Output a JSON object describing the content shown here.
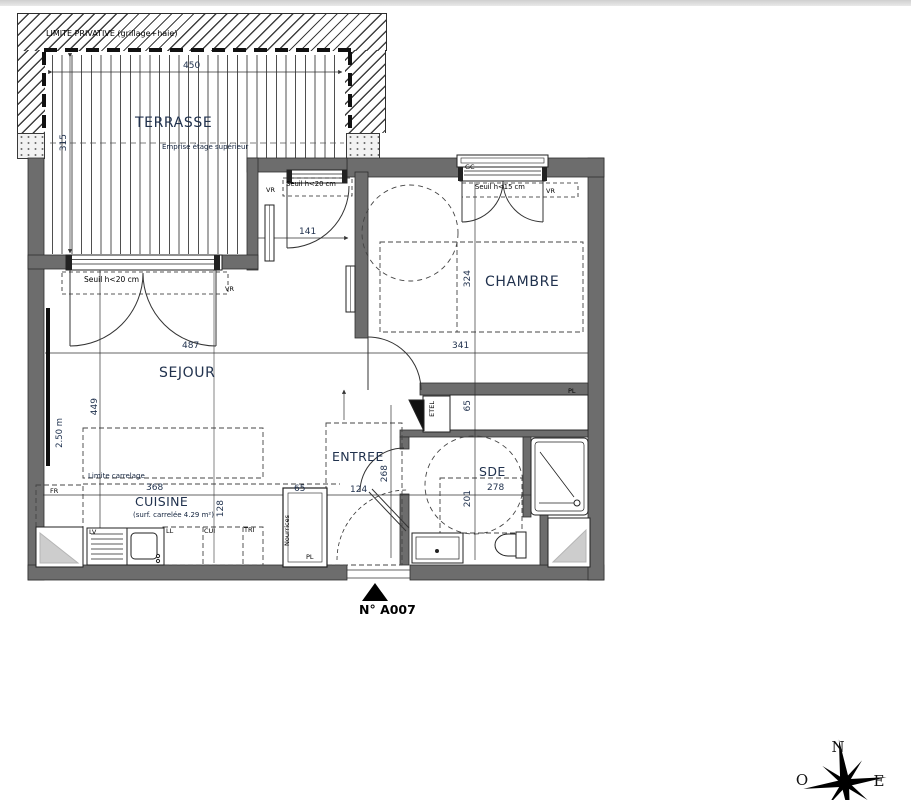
{
  "plan": {
    "boundary_label": "LIMITE PRIVATIVE (grillage+haie)",
    "unit_number": "N° A007",
    "terrace": {
      "name": "TERRASSE",
      "width": "450",
      "depth": "315",
      "upper_floor_note": "Emprise étage supérieur"
    },
    "living_room": {
      "name": "SEJOUR",
      "width": "487",
      "depth": "449",
      "ceiling_height": "2.50 m",
      "bay_threshold": "Seuil h<20 cm",
      "bay_shutter": "VR",
      "door_width": "141",
      "door_threshold": "Seuil h<20 cm",
      "door_shutter": "VR"
    },
    "bedroom": {
      "name": "CHAMBRE",
      "width": "341",
      "depth": "324",
      "closet": "PL",
      "window_threshold": "Seuil h<15 cm",
      "window_shutter": "VR",
      "window_tag": "GC"
    },
    "kitchen": {
      "name": "CUISINE",
      "area_note": "(surf. carrelée 4.29 m²)",
      "tile_limit": "Limite carrelage",
      "width": "368",
      "depth": "128",
      "fridge": "FR",
      "dishwasher": "LV",
      "washing_machine": "LL",
      "cooker": "CUI",
      "waste": "TRI"
    },
    "hall": {
      "name": "ENTREE",
      "width": "124",
      "depth": "268",
      "closet_width": "65",
      "closet_label": "Nourrices",
      "closet_tag": "PL",
      "electrical_panel": "ETEL",
      "shelf_depth": "65"
    },
    "shower_room": {
      "name": "SDE",
      "width": "278",
      "depth": "201"
    },
    "compass": {
      "north": "N",
      "west": "O",
      "east": "E"
    }
  }
}
